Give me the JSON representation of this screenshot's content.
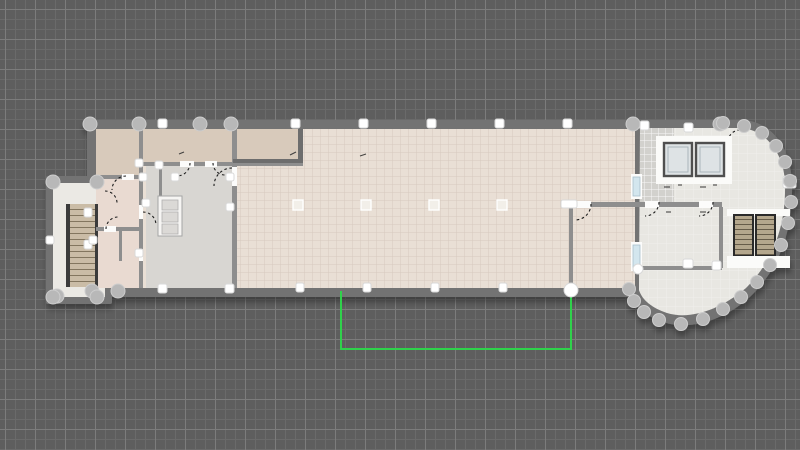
{
  "app": {
    "name": "floor-plan-editor",
    "view": "2d-plan-canvas"
  },
  "canvas": {
    "grid_visible": true,
    "grid_minor_px": 10,
    "grid_major_px": 30
  },
  "colors": {
    "canvas_bg": "#5e5e5e",
    "grid_minor": "#6a6a6a",
    "grid_major": "#7c7c7c",
    "wall_outer": "#737373",
    "wall_inner": "#8e8e8e",
    "wall_dark": "#6d6d6d",
    "floor_hall": "#e9dfd5",
    "floor_tan": "#d8cabb",
    "floor_pink": "#e9dad1",
    "floor_gray": "#d8d6d2",
    "floor_white": "#ebe9e4",
    "floor_wing": "#e8e7e2",
    "floor_tile": "#d2d1cd",
    "stair_tread": "#cabca6",
    "escalator_tread": "#b4a78d",
    "accent_green": "#2fd24b",
    "handle_gray": "#b8b8b8",
    "handle_white": "#ffffff",
    "window_blue": "#d3e6ee",
    "elevator_fill": "#dee3e5",
    "elevator_frame": "#4f4f4f",
    "door_arc": "#1f1f1f"
  },
  "plan": {
    "inventory": {
      "elevators": 2,
      "escalators": 2,
      "staircases": 1,
      "service_shafts": 1,
      "windows": 2,
      "hall_interior_columns": 4
    },
    "draft_outline": {
      "color": "#2fd24b",
      "shape": "open-rectangle",
      "open_side": "top",
      "endpoint_handles": 1
    }
  }
}
